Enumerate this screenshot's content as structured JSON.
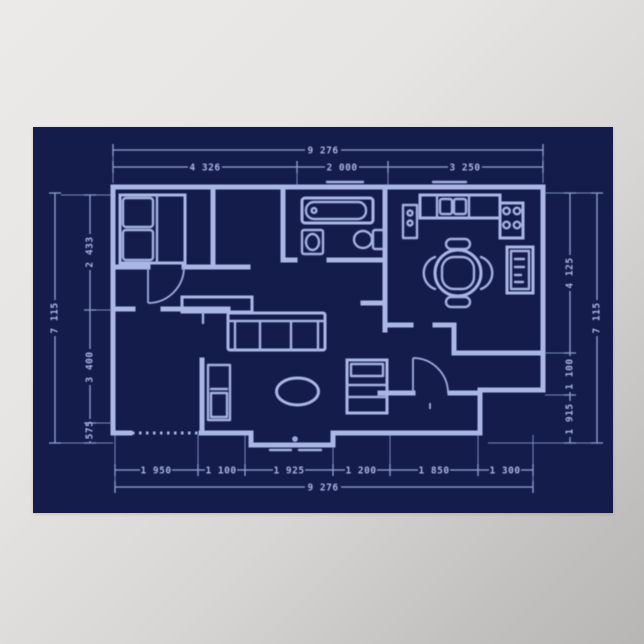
{
  "poster": {
    "type": "blueprint-floor-plan",
    "colors": {
      "paper": "#141c4c",
      "ink": "#a4b1e0",
      "ink_bright": "#aab7e6",
      "dim_line": "#93a2d6",
      "wall_background_top": "#ebeae8",
      "wall_background_bottom": "#b8b6b4"
    }
  },
  "dimensions": {
    "top": {
      "total": "9 276",
      "segments": [
        "4 326",
        "2 000",
        "3 250"
      ]
    },
    "bottom": {
      "total": "9 276",
      "segments": [
        "1 950",
        "1 100",
        "1 925",
        "1 200",
        "1 850",
        "1 300"
      ]
    },
    "left": {
      "total": "7 115",
      "segments": [
        "2 433",
        "3 400",
        "575"
      ]
    },
    "right": {
      "total": "7 115",
      "segments": [
        "4 125",
        "1 100",
        "1 915"
      ]
    }
  },
  "furniture": [
    "double-bed",
    "bathtub",
    "washbasin",
    "toilet",
    "kitchen-counter",
    "kitchen-sink",
    "stove",
    "refrigerator",
    "dining-table",
    "dining-chairs",
    "sofa",
    "coffee-table",
    "armchair",
    "sideboard",
    "bookshelf"
  ]
}
